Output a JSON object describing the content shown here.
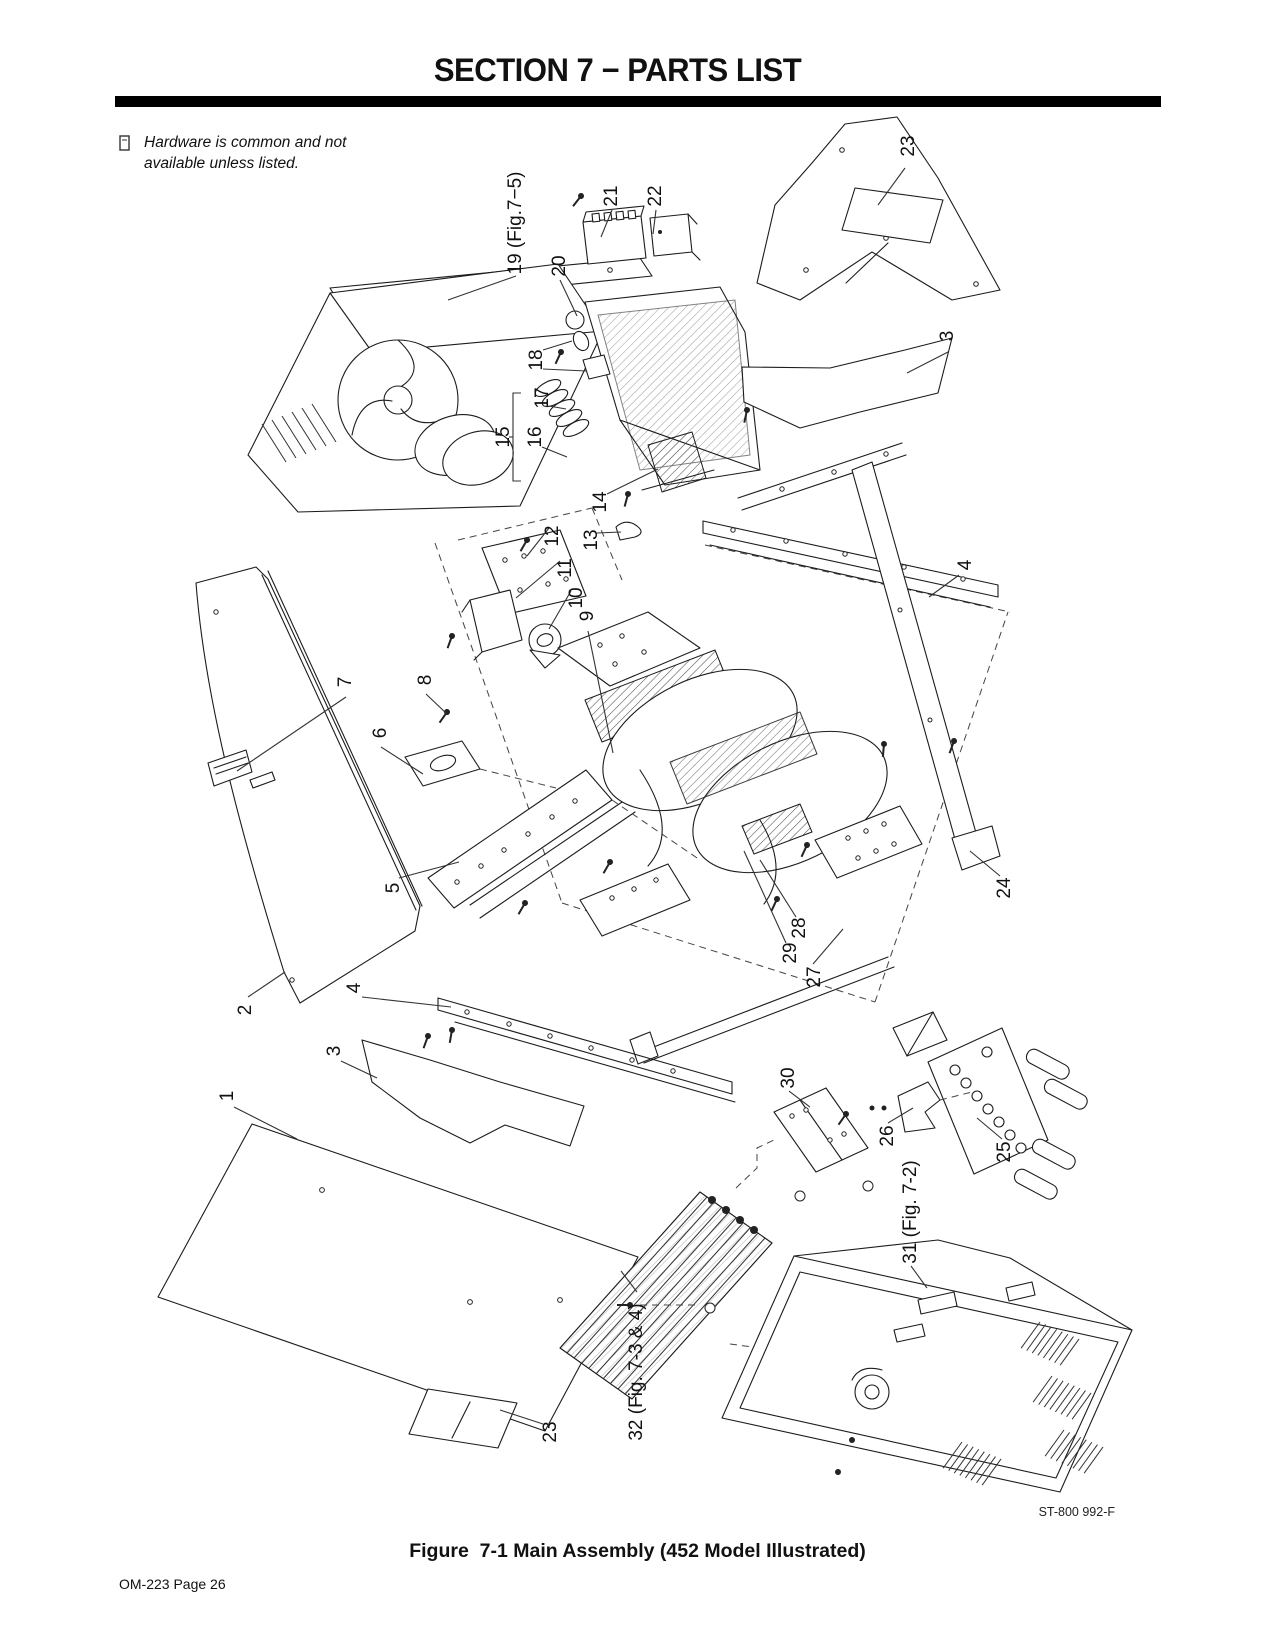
{
  "page": {
    "header": {
      "title": "SECTION 7 − PARTS LIST"
    },
    "note": {
      "icon": "hardware-note-icon",
      "text": "Hardware is common and not available unless listed."
    },
    "figure": {
      "caption": "Figure  7-1 Main Assembly (452 Model Illustrated)",
      "drawing_ref": "ST-800 992-F"
    },
    "footer": {
      "page_label": "OM-223 Page 26"
    }
  },
  "diagram": {
    "description": "Exploded isometric view of welding power source main assembly",
    "callouts": [
      {
        "label": "23",
        "x": 909,
        "y": 146,
        "leaders": [
          [
            905,
            168,
            878,
            205
          ]
        ]
      },
      {
        "label": "19 (Fig.7−5)",
        "x": 516,
        "y": 223,
        "leaders": [
          [
            516,
            276,
            448,
            300
          ]
        ]
      },
      {
        "label": "21",
        "x": 612,
        "y": 196,
        "leaders": [
          [
            612,
            210,
            601,
            237
          ]
        ]
      },
      {
        "label": "22",
        "x": 656,
        "y": 196,
        "leaders": [
          [
            656,
            210,
            653,
            234
          ]
        ]
      },
      {
        "label": "20",
        "x": 560,
        "y": 266,
        "leaders": [
          [
            560,
            280,
            577,
            316
          ]
        ]
      },
      {
        "label": "18",
        "x": 537,
        "y": 360,
        "leaders": [
          [
            543,
            350,
            572,
            341
          ],
          [
            543,
            369,
            586,
            371
          ]
        ]
      },
      {
        "label": "17",
        "x": 543,
        "y": 398,
        "leaders": [
          [
            549,
            406,
            566,
            409
          ]
        ]
      },
      {
        "label": "15",
        "x": 504,
        "y": 437,
        "leaders": []
      },
      {
        "label": "16",
        "x": 536,
        "y": 437,
        "leaders": [
          [
            542,
            447,
            567,
            457
          ]
        ]
      },
      {
        "label": "14",
        "x": 601,
        "y": 502,
        "leaders": [
          [
            607,
            494,
            658,
            469
          ]
        ]
      },
      {
        "label": "3",
        "x": 948,
        "y": 336,
        "leaders": [
          [
            948,
            352,
            907,
            373
          ]
        ]
      },
      {
        "label": "13",
        "x": 592,
        "y": 540,
        "leaders": [
          [
            597,
            533,
            621,
            532
          ]
        ]
      },
      {
        "label": "12",
        "x": 553,
        "y": 536,
        "leaders": [
          [
            549,
            528,
            527,
            556
          ]
        ]
      },
      {
        "label": "11",
        "x": 566,
        "y": 568,
        "leaders": [
          [
            560,
            561,
            516,
            598
          ]
        ]
      },
      {
        "label": "10",
        "x": 577,
        "y": 598,
        "leaders": [
          [
            571,
            591,
            549,
            629
          ]
        ]
      },
      {
        "label": "9",
        "x": 588,
        "y": 616,
        "leaders": [
          [
            588,
            631,
            613,
            753
          ]
        ]
      },
      {
        "label": "4",
        "x": 966,
        "y": 565,
        "leaders": [
          [
            959,
            575,
            929,
            597
          ]
        ]
      },
      {
        "label": "7",
        "x": 346,
        "y": 682,
        "leaders": [
          [
            346,
            697,
            237,
            771
          ]
        ]
      },
      {
        "label": "8",
        "x": 426,
        "y": 680,
        "leaders": [
          [
            426,
            694,
            447,
            714
          ]
        ]
      },
      {
        "label": "6",
        "x": 381,
        "y": 733,
        "leaders": [
          [
            381,
            747,
            423,
            774
          ]
        ]
      },
      {
        "label": "5",
        "x": 394,
        "y": 888,
        "leaders": [
          [
            399,
            878,
            459,
            862
          ]
        ]
      },
      {
        "label": "24",
        "x": 1005,
        "y": 888,
        "leaders": [
          [
            1000,
            876,
            970,
            851
          ]
        ]
      },
      {
        "label": "28",
        "x": 800,
        "y": 928,
        "leaders": [
          [
            796,
            917,
            760,
            860
          ]
        ]
      },
      {
        "label": "29",
        "x": 791,
        "y": 953,
        "leaders": [
          [
            786,
            943,
            744,
            851
          ]
        ]
      },
      {
        "label": "27",
        "x": 815,
        "y": 977,
        "leaders": [
          [
            813,
            964,
            843,
            929
          ]
        ]
      },
      {
        "label": "2",
        "x": 246,
        "y": 1010,
        "leaders": [
          [
            248,
            997,
            285,
            972
          ]
        ]
      },
      {
        "label": "4",
        "x": 355,
        "y": 988,
        "leaders": [
          [
            362,
            997,
            451,
            1007
          ]
        ]
      },
      {
        "label": "3",
        "x": 335,
        "y": 1051,
        "leaders": [
          [
            341,
            1061,
            377,
            1078
          ]
        ]
      },
      {
        "label": "1",
        "x": 228,
        "y": 1096,
        "leaders": [
          [
            234,
            1107,
            297,
            1139
          ]
        ]
      },
      {
        "label": "30",
        "x": 789,
        "y": 1078,
        "leaders": [
          [
            789,
            1091,
            810,
            1107
          ]
        ]
      },
      {
        "label": "26",
        "x": 888,
        "y": 1136,
        "leaders": [
          [
            888,
            1123,
            913,
            1108
          ]
        ]
      },
      {
        "label": "25",
        "x": 1005,
        "y": 1152,
        "leaders": [
          [
            1002,
            1139,
            977,
            1118
          ]
        ]
      },
      {
        "label": "31 (Fig. 7-2)",
        "x": 911,
        "y": 1212,
        "leaders": [
          [
            911,
            1266,
            927,
            1288
          ]
        ]
      },
      {
        "label": "32 (Fig. 7-3 & 4)",
        "x": 637,
        "y": 1372,
        "leaders": [
          [
            637,
            1292,
            621,
            1271
          ]
        ]
      },
      {
        "label": "23",
        "x": 551,
        "y": 1432,
        "leaders": [
          [
            543,
            1424,
            500,
            1410
          ]
        ]
      }
    ]
  }
}
